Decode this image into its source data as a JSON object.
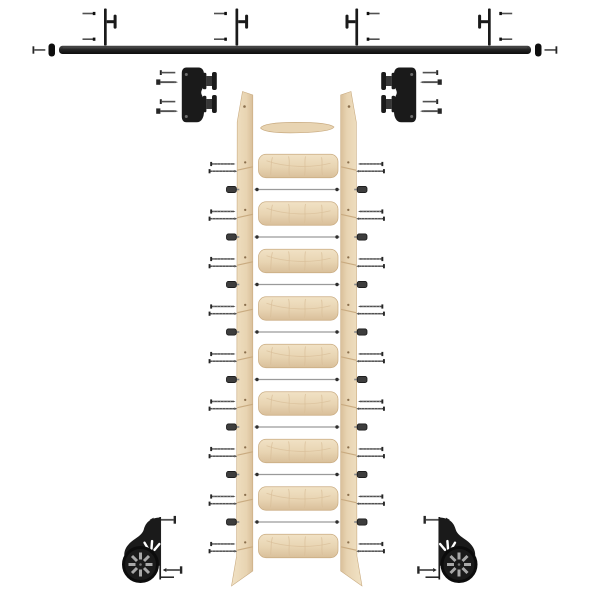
{
  "page": {
    "description": "Exploded product view of a rolling library ladder kit: black wall rail with mounting brackets, two top roller carriages, unfinished wood ladder with nine treads and tie rods, and two black spoked floor wheel casters",
    "background": "#ffffff"
  },
  "colors": {
    "background": "#ffffff",
    "hardware": "#1a1a1a",
    "hardware-dark": "#0e0e0e",
    "hardware-mid": "#3a3a3a",
    "screw": "#515151",
    "screw-dark": "#262626",
    "rod": "#9a9a9a",
    "wood-light": "#f1e2c5",
    "wood": "#e8d4b2",
    "wood-dark": "#d9bf9a",
    "wood-edge": "#c9ab80",
    "wood-hole": "#8a6f4d"
  },
  "parts": [
    {
      "name": "wall rail",
      "qty": 1
    },
    {
      "name": "rail end stop",
      "qty": 2
    },
    {
      "name": "rail end screw",
      "qty": 2
    },
    {
      "name": "rail mounting bracket",
      "qty": 4
    },
    {
      "name": "bracket screw",
      "qty": 8
    },
    {
      "name": "top roller carriage",
      "qty": 2
    },
    {
      "name": "carriage screw",
      "qty": 8
    },
    {
      "name": "ladder stile",
      "qty": 2
    },
    {
      "name": "top step",
      "qty": 1
    },
    {
      "name": "ladder tread",
      "qty": 9
    },
    {
      "name": "tie rod",
      "qty": 8
    },
    {
      "name": "tie rod nut",
      "qty": 16
    },
    {
      "name": "tread screw",
      "qty": 36
    },
    {
      "name": "floor wheel caster",
      "qty": 2
    },
    {
      "name": "caster screw",
      "qty": 4
    }
  ],
  "geometry": {
    "tread_centers_y": [
      166,
      213.5,
      261,
      308.5,
      356,
      403.5,
      451,
      498.5,
      546
    ],
    "rod_y": [
      189.5,
      237,
      284.5,
      332,
      379.5,
      427,
      474.5,
      522
    ],
    "bracket_plate_x": [
      104,
      235.5,
      355.4,
      488
    ],
    "bracket_facing": [
      "right",
      "right",
      "left",
      "left"
    ],
    "ladder_mirror_x": 593.5,
    "carriage_mirror_x": 598,
    "wheel_mirror_x": 599.5
  }
}
